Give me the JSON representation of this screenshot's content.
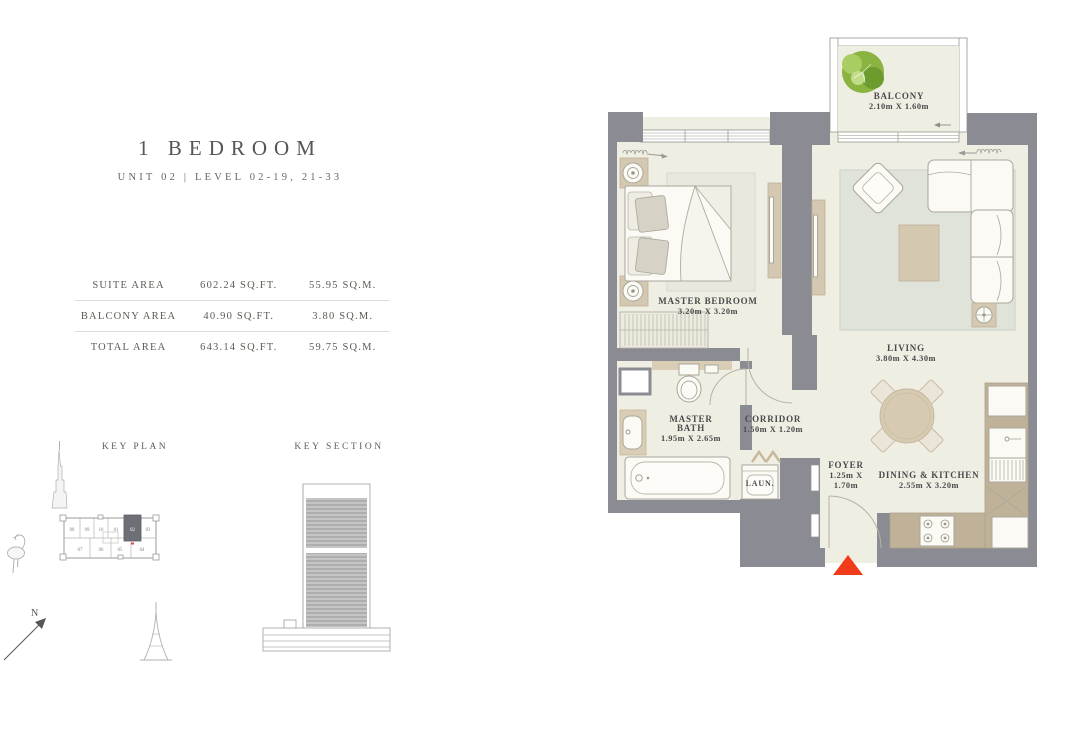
{
  "header": {
    "title": "1 BEDROOM",
    "subtitle": "UNIT 02 | LEVEL 02-19, 21-33"
  },
  "area_table": {
    "rows": [
      {
        "label": "SUITE AREA",
        "sqft": "602.24 SQ.FT.",
        "sqm": "55.95 SQ.M."
      },
      {
        "label": "BALCONY AREA",
        "sqft": "40.90 SQ.FT.",
        "sqm": "3.80 SQ.M."
      },
      {
        "label": "TOTAL AREA",
        "sqft": "643.14 SQ.FT.",
        "sqm": "59.75 SQ.M."
      }
    ]
  },
  "key_plan": {
    "label": "KEY PLAN",
    "north_label": "N",
    "units_top": [
      "08",
      "09",
      "10",
      "01",
      "02",
      "03"
    ],
    "units_bottom": [
      "07",
      "06",
      "05",
      "04"
    ],
    "highlighted_unit": "02"
  },
  "key_section": {
    "label": "KEY SECTION"
  },
  "floor_plan": {
    "balcony": {
      "name": "BALCONY",
      "dims": "2.10m X 1.60m"
    },
    "master_bedroom": {
      "name": "MASTER BEDROOM",
      "dims": "3.20m X 3.20m"
    },
    "living": {
      "name": "LIVING",
      "dims": "3.80m X 4.30m"
    },
    "master_bath": {
      "name_line1": "MASTER",
      "name_line2": "BATH",
      "dims": "1.95m X 2.65m"
    },
    "corridor": {
      "name": "CORRIDOR",
      "dims": "1.50m X 1.20m"
    },
    "laundry": {
      "name": "LAUN."
    },
    "foyer": {
      "name": "FOYER",
      "dims_line1": "1.25m X",
      "dims_line2": "1.70m"
    },
    "dining_kitchen": {
      "name": "DINING & KITCHEN",
      "dims": "2.55m X 3.20m"
    }
  },
  "colors": {
    "wall": "#8b8b93",
    "floor": "#efeee3",
    "rug": "#dfe3da",
    "accent_tan": "#d5c8b0",
    "counter_tan": "#bfb298",
    "entry_marker": "#f23b1b",
    "tree_green": "#8ab33f",
    "text": "#4e4e50"
  }
}
